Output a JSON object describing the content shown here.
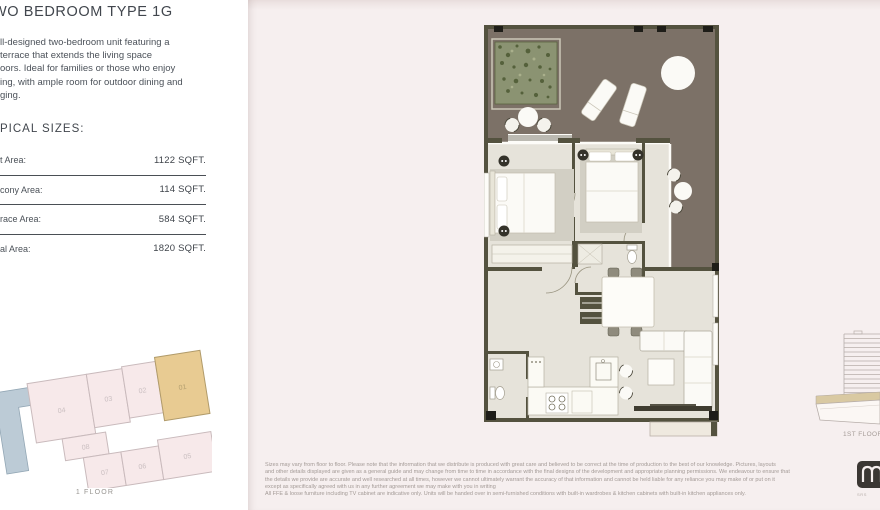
{
  "colors": {
    "page-bg": "#f6efef",
    "panel-bg": "#ffffff",
    "ink": "#41464d",
    "wall": "#54523f",
    "floor": "#e6e3da",
    "terrace": "#7c7167",
    "planter": "#8b9372",
    "keyplan-pink": "#f7e9ea",
    "highlight-tan": "#e8cb92",
    "keyplan-blue": "#bccbd6",
    "elev-band": "#d9c9a2"
  },
  "left_panel": {
    "title": "WO BEDROOM TYPE 1G",
    "description_lines": [
      "ll-designed two-bedroom unit featuring a",
      "terrace that extends the living space",
      "oors. Ideal for families or those who enjoy",
      "ing, with ample room for outdoor dining and",
      "ging."
    ],
    "sizes_heading": "PICAL SIZES:",
    "size_rows": [
      {
        "label": "t Area:",
        "value": "1122 SQFT."
      },
      {
        "label": "cony Area:",
        "value": "114 SQFT."
      },
      {
        "label": "race Area:",
        "value": "584 SQFT."
      },
      {
        "label": "al Area:",
        "value": "1820 SQFT."
      }
    ]
  },
  "keyplan": {
    "units": [
      "04",
      "03",
      "02",
      "01",
      "08",
      "07",
      "06",
      "05"
    ],
    "highlighted_unit": "01",
    "caption": "1 FLOOR"
  },
  "elevation": {
    "label": "1ST FLOOR"
  },
  "disclaimer": {
    "lines": [
      "Sizes may vary from floor to floor. Please note that the information that we distribute is produced with great care and believed to be correct at the time of production to the best of our knowledge. Pictures, layouts",
      "and other details displayed are given as a general guide and may change from time to time in accordance with the final designs of the development and appropriate planning permissions. We endeavour to ensure that",
      "the details we provide are accurate and well researched at all times, however we cannot ultimately warrant the accuracy of that information and cannot be held liable for any reliance you may make of or put on it",
      "except as specifically agreed with us in any further agreement we may make with you in writing",
      "All FFE & loose furniture including TV cabinet are indicative only. Units will be handed over in semi-furnished conditions with built-in wardrobes & kitchen cabinets with built-in kitchen appliances only."
    ]
  },
  "logo": {
    "caption": "SRS"
  }
}
